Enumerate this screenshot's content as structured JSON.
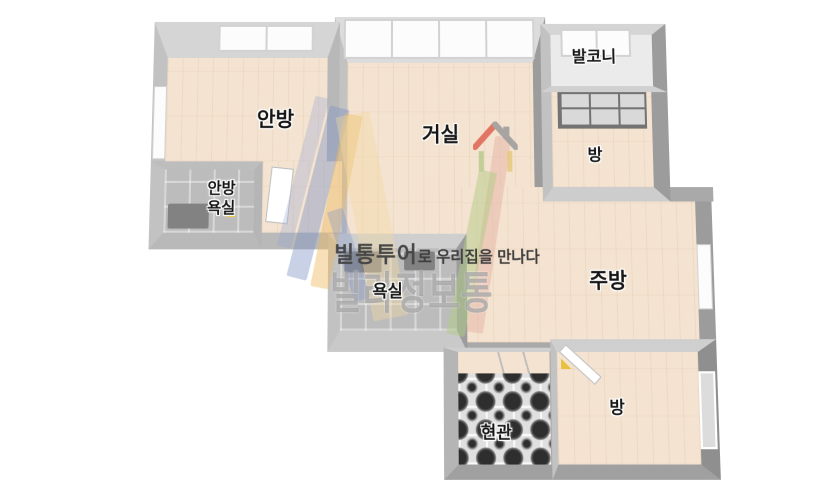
{
  "plan": {
    "type": "apartment-floor-plan-3d",
    "background": "#ffffff"
  },
  "rooms": {
    "anbang": {
      "label": "안방"
    },
    "geosil": {
      "label": "거실"
    },
    "balkoni": {
      "label": "발코니"
    },
    "bang_top": {
      "label": "방"
    },
    "anbang_yoksil": {
      "label": "안방 욕실",
      "line1": "안방",
      "line2": "욕실"
    },
    "yoksil": {
      "label": "욕실"
    },
    "jubang": {
      "label": "주방"
    },
    "hyeongwan": {
      "label": "현관"
    },
    "bang_bottom": {
      "label": "방"
    }
  },
  "watermark": {
    "brand": "빌통투어",
    "tagline": "로 우리집을 만나다",
    "brand_large": "빌라정보통"
  },
  "colors": {
    "floor_wood": "#f4e3d0",
    "wall_top": "#d5d5d5",
    "wall_side_dark": "#9c9c9c",
    "bath_tile": "#bcbcbc",
    "logo_blue": "#7d91c4",
    "logo_yellow": "#eeba62",
    "logo_pink": "#e4aca2",
    "logo_green": "#b2cb86",
    "logo_house_red": "#e06352"
  }
}
